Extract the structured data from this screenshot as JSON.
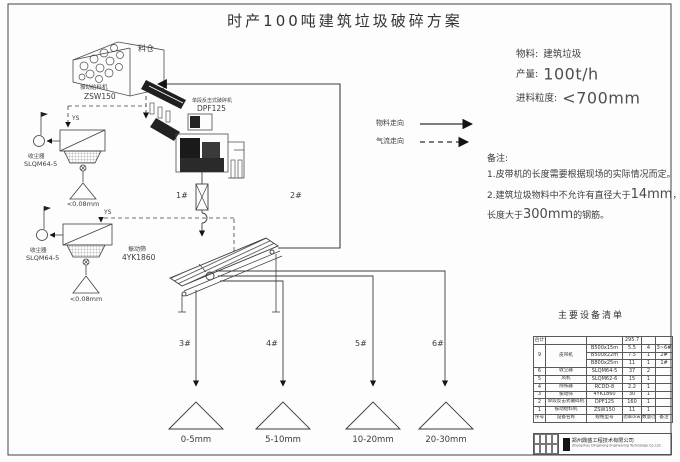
{
  "title": "时产100吨建筑垃圾破碎方案",
  "info": {
    "material_label": "物料:",
    "material_value": "建筑垃圾",
    "capacity_label": "产量:",
    "capacity_value": "100t/h",
    "feed_label": "进料粒度:",
    "feed_value": "<700mm"
  },
  "legend": {
    "material_flow": "物料走向",
    "air_flow": "气流走向"
  },
  "notes": {
    "heading": "备注:",
    "line1": "1.皮带机的长度需要根据现场的实际情况而定。",
    "line2_a": "2.建筑垃圾物料中不允许有直径大于",
    "line2_b": "14mm",
    "line2_c": "，",
    "line3_a": "长度大于",
    "line3_b": "300mm",
    "line3_c": "的钢筋。"
  },
  "equipment": {
    "silo_label": "料仓",
    "feeder": {
      "name": "振动给料机",
      "model": "ZSW150"
    },
    "crusher": {
      "name": "单段反击式破碎机",
      "model": "DPF125"
    },
    "screen": {
      "name": "振动筛",
      "model": "4YK1860"
    },
    "dust_upper": {
      "name": "收尘器",
      "model": "SLQM64-5",
      "fines": "<0.08mm",
      "duct": "YS"
    },
    "dust_lower": {
      "name": "收尘器",
      "model": "SLQM64-5",
      "fines": "<0.08mm",
      "duct": "YS"
    }
  },
  "conveyors": [
    "1#",
    "2#",
    "3#",
    "4#",
    "5#",
    "6#"
  ],
  "outputs": [
    "0-5mm",
    "5-10mm",
    "10-20mm",
    "20-30mm"
  ],
  "table": {
    "title": "主要设备清单",
    "total": {
      "label": "合计",
      "value": "295.7"
    },
    "rows": [
      {
        "no": "9",
        "name": "皮带机",
        "model": "B500x15m",
        "power": "5.5",
        "qty": "4",
        "note": "3~6#"
      },
      {
        "model": "B500x22m",
        "power": "7.5",
        "qty": "1",
        "note": "2#"
      },
      {
        "model": "B800x25m",
        "power": "11",
        "qty": "1",
        "note": "1#"
      },
      {
        "no": "6",
        "name": "收尘器",
        "model": "SLQM64-5",
        "power": "37",
        "qty": "2",
        "note": ""
      },
      {
        "no": "5",
        "name": "风机",
        "model": "SLQM62-6",
        "power": "15",
        "qty": "1",
        "note": ""
      },
      {
        "no": "4",
        "name": "除铁器",
        "model": "RCDD-8",
        "power": "2.2",
        "qty": "1",
        "note": ""
      },
      {
        "no": "3",
        "name": "振动筛",
        "model": "4YK1860",
        "power": "30",
        "qty": "1",
        "note": ""
      },
      {
        "no": "2",
        "name": "单段反击式破碎机",
        "model": "DPF125",
        "power": "160",
        "qty": "1",
        "note": ""
      },
      {
        "no": "1",
        "name": "振动给料机",
        "model": "ZSW150",
        "power": "11",
        "qty": "1",
        "note": ""
      }
    ],
    "header": {
      "no": "序号",
      "name": "设备名称",
      "model": "规格型号",
      "power": "功率(kw)",
      "qty": "数量(台)",
      "note": "备注"
    },
    "company_cn": "郑州鼎盛工程技术有限公司",
    "company_en": "Zhengzhou Dingsheng Engineering Technology Co.,Ltd."
  },
  "colors": {
    "line": "#4a4a4a",
    "dark": "#1a1a1a",
    "text": "#3c3c3c"
  }
}
